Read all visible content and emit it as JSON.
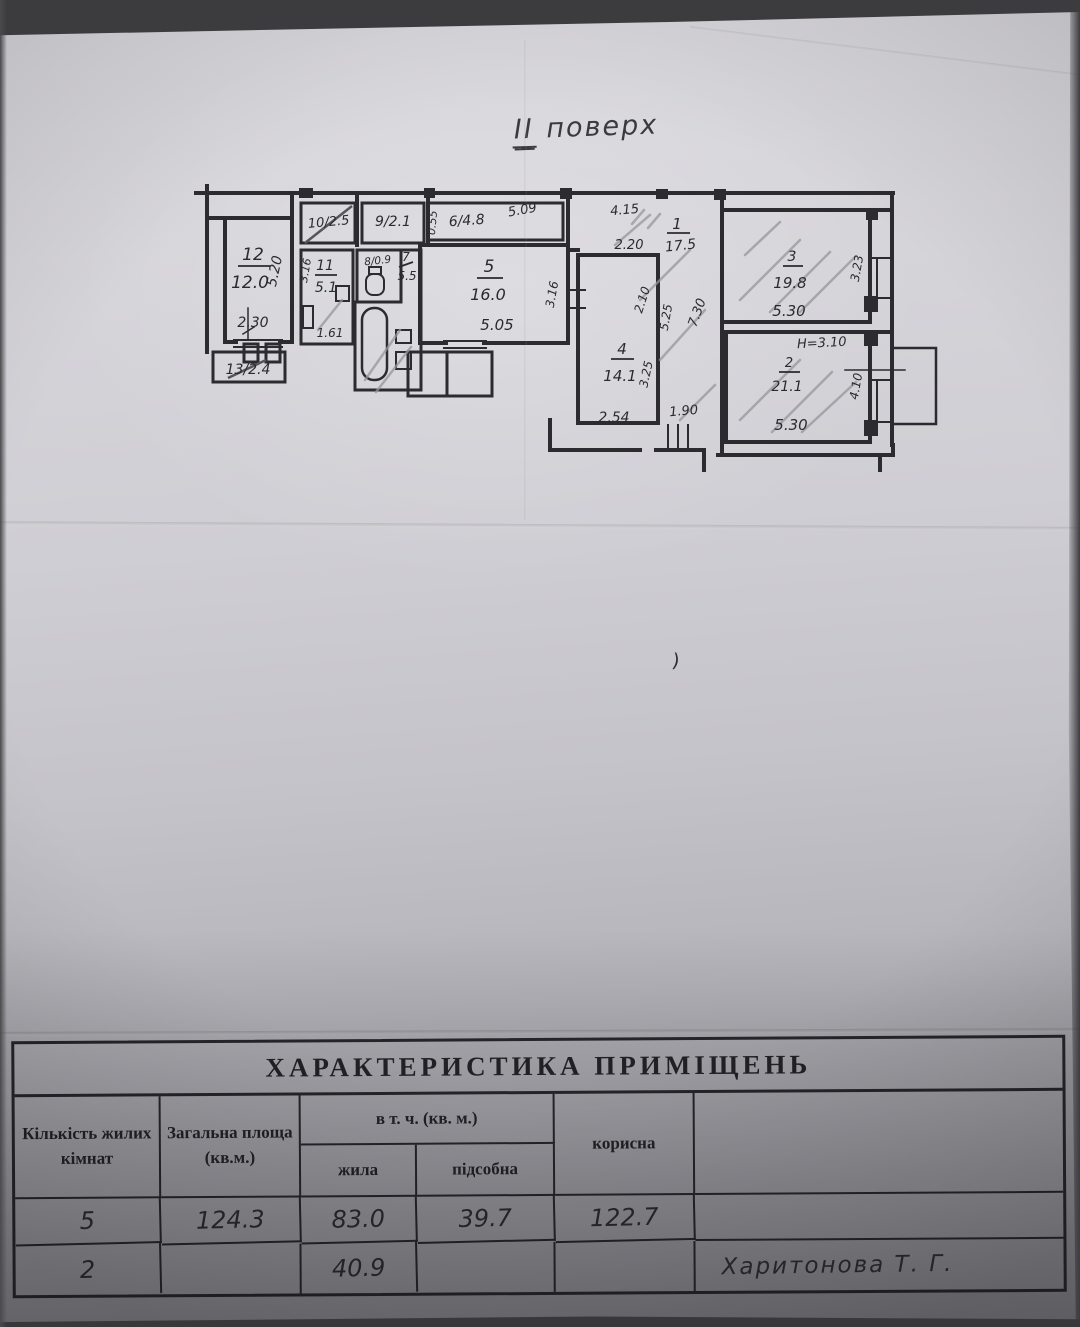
{
  "colors": {
    "ink": "#2b2b30",
    "pencil": "#97969c",
    "paper": "#d2d1d6"
  },
  "title": {
    "floor_numeral": "ІІ",
    "floor_word": "поверх"
  },
  "stray_mark": ")",
  "plan": {
    "rooms": {
      "r12": {
        "num": "12",
        "area": "12.0"
      },
      "r13": {
        "label": "13/2.4"
      },
      "r10": {
        "label": "10/2.5"
      },
      "r11": {
        "num": "11",
        "area": "5.1"
      },
      "r9": {
        "label": "9/2.1"
      },
      "r8": {
        "label": "8/0.9"
      },
      "r7": {
        "num": "7",
        "area": "5.5"
      },
      "r6": {
        "label": "6/4.8"
      },
      "r5": {
        "num": "5",
        "area": "16.0"
      },
      "r4": {
        "num": "4",
        "area": "14.1"
      },
      "r1": {
        "num": "1",
        "area": "17.5"
      },
      "r3": {
        "num": "3",
        "area": "19.8"
      },
      "r2": {
        "num": "2",
        "area": "21.1"
      }
    },
    "dims": {
      "h520": "5.20",
      "w230": "2.30",
      "w161": "1.61",
      "h316a": "3.16",
      "h055": "0.55",
      "w509": "5.09",
      "w505": "5.05",
      "h316b": "3.16",
      "w415": "4.15",
      "w220": "2.20",
      "h210": "2.10",
      "h525": "5.25",
      "h730": "7.30",
      "h325": "3.25",
      "w254": "2.54",
      "w190": "1.90",
      "w530a": "5.30",
      "h323": "3.23",
      "w530b": "5.30",
      "h410": "4.10",
      "ceiling": "H=3.10"
    }
  },
  "table": {
    "title": "ХАРАКТЕРИСТИКА ПРИМІЩЕНЬ",
    "headers": {
      "rooms": "Кількість жилих кімнат",
      "total": "Загальна площа (кв.м.)",
      "incl": "в т. ч. (кв. м.)",
      "living": "жила",
      "aux": "підсобна",
      "useful": "корисна"
    },
    "rows": [
      {
        "rooms": "5",
        "total": "124.3",
        "living": "83.0",
        "aux": "39.7",
        "useful": "122.7",
        "note": ""
      },
      {
        "rooms": "2",
        "total": "",
        "living": "40.9",
        "aux": "",
        "useful": "",
        "note": "Харитонова Т. Г."
      }
    ]
  }
}
